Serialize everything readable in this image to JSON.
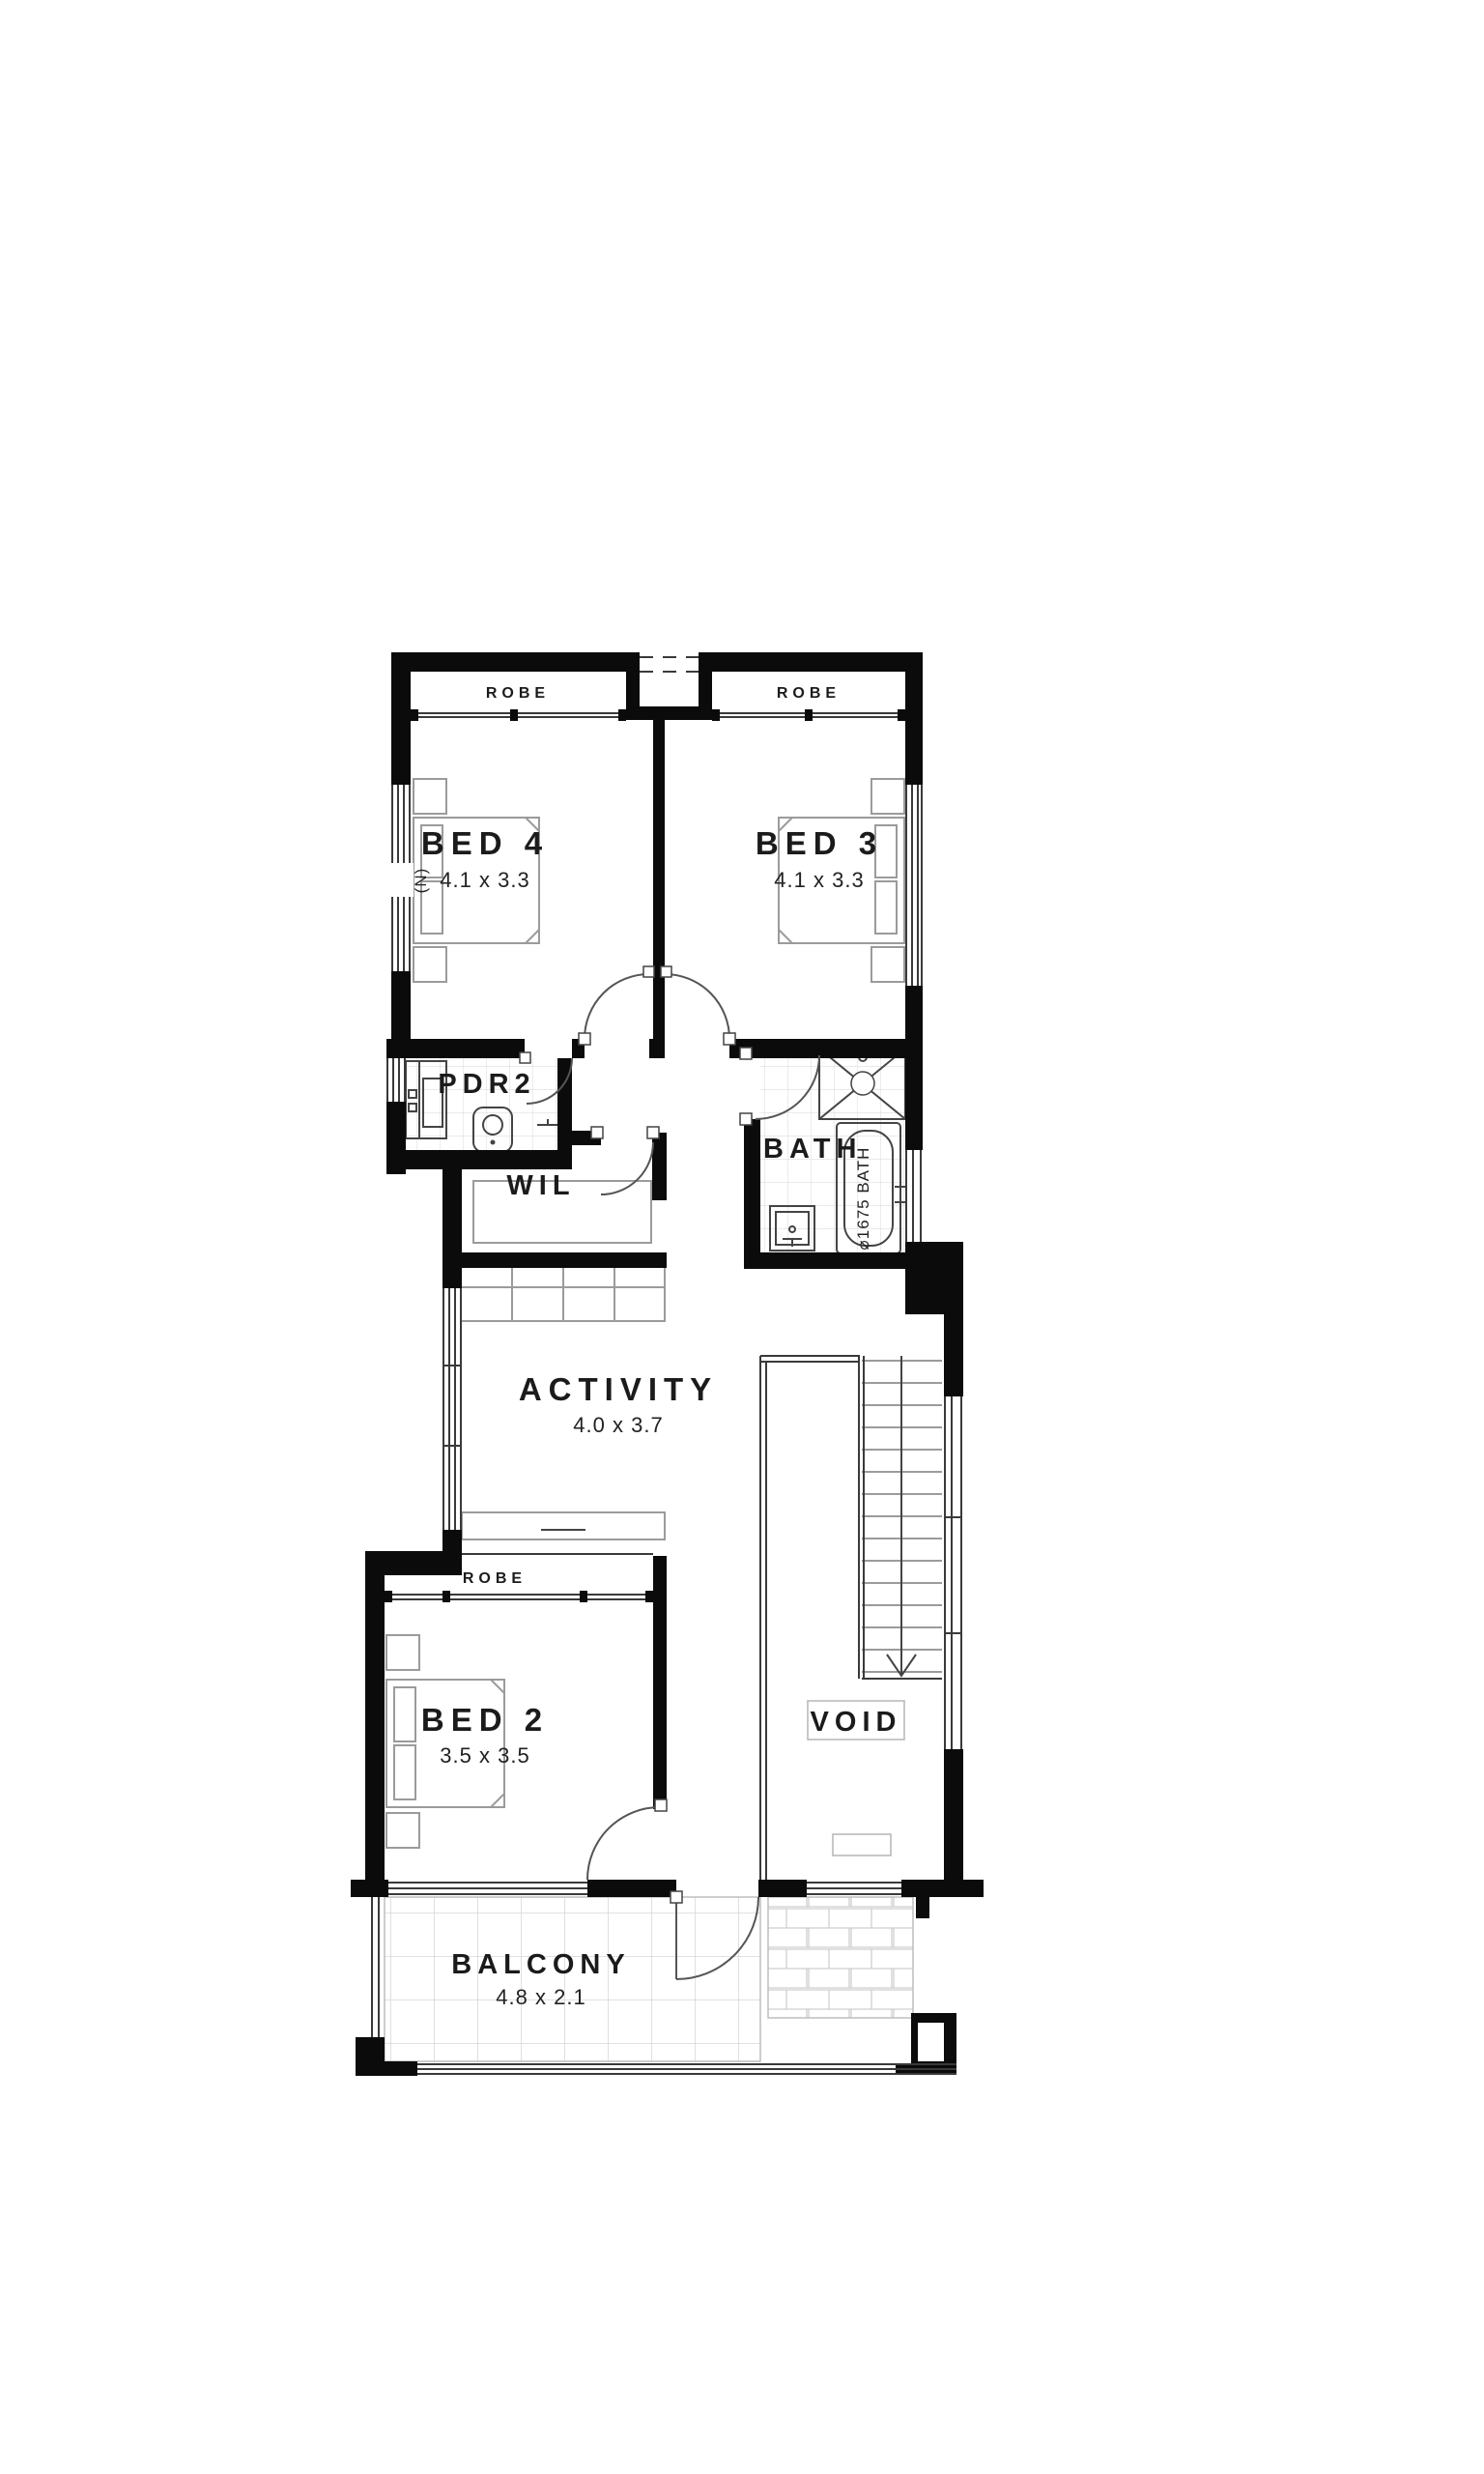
{
  "plan": {
    "type": "floor-plan",
    "rooms": {
      "bed4": {
        "name": "BED 4",
        "dims": "4.1 x 3.3",
        "robe": "ROBE"
      },
      "bed3": {
        "name": "BED 3",
        "dims": "4.1 x 3.3",
        "robe": "ROBE"
      },
      "bed2": {
        "name": "BED 2",
        "dims": "3.5 x 3.5",
        "robe": "ROBE"
      },
      "activity": {
        "name": "ACTIVITY",
        "dims": "4.0 x 3.7"
      },
      "balcony": {
        "name": "BALCONY",
        "dims": "4.8 x 2.1"
      },
      "bath": {
        "name": "BATH",
        "tub_label": "⌀1675 BATH"
      },
      "pdr2": {
        "name": "PDR2"
      },
      "wil": {
        "name": "WIL"
      },
      "void": {
        "name": "VOID"
      }
    },
    "annotations": {
      "north_marker": "(N)"
    },
    "colors": {
      "wall": "#0b0b0b",
      "background": "#ffffff",
      "fixture_line": "#9b9b9b",
      "tile_line": "#d9d9d9",
      "text": "#1b1b1b"
    }
  }
}
